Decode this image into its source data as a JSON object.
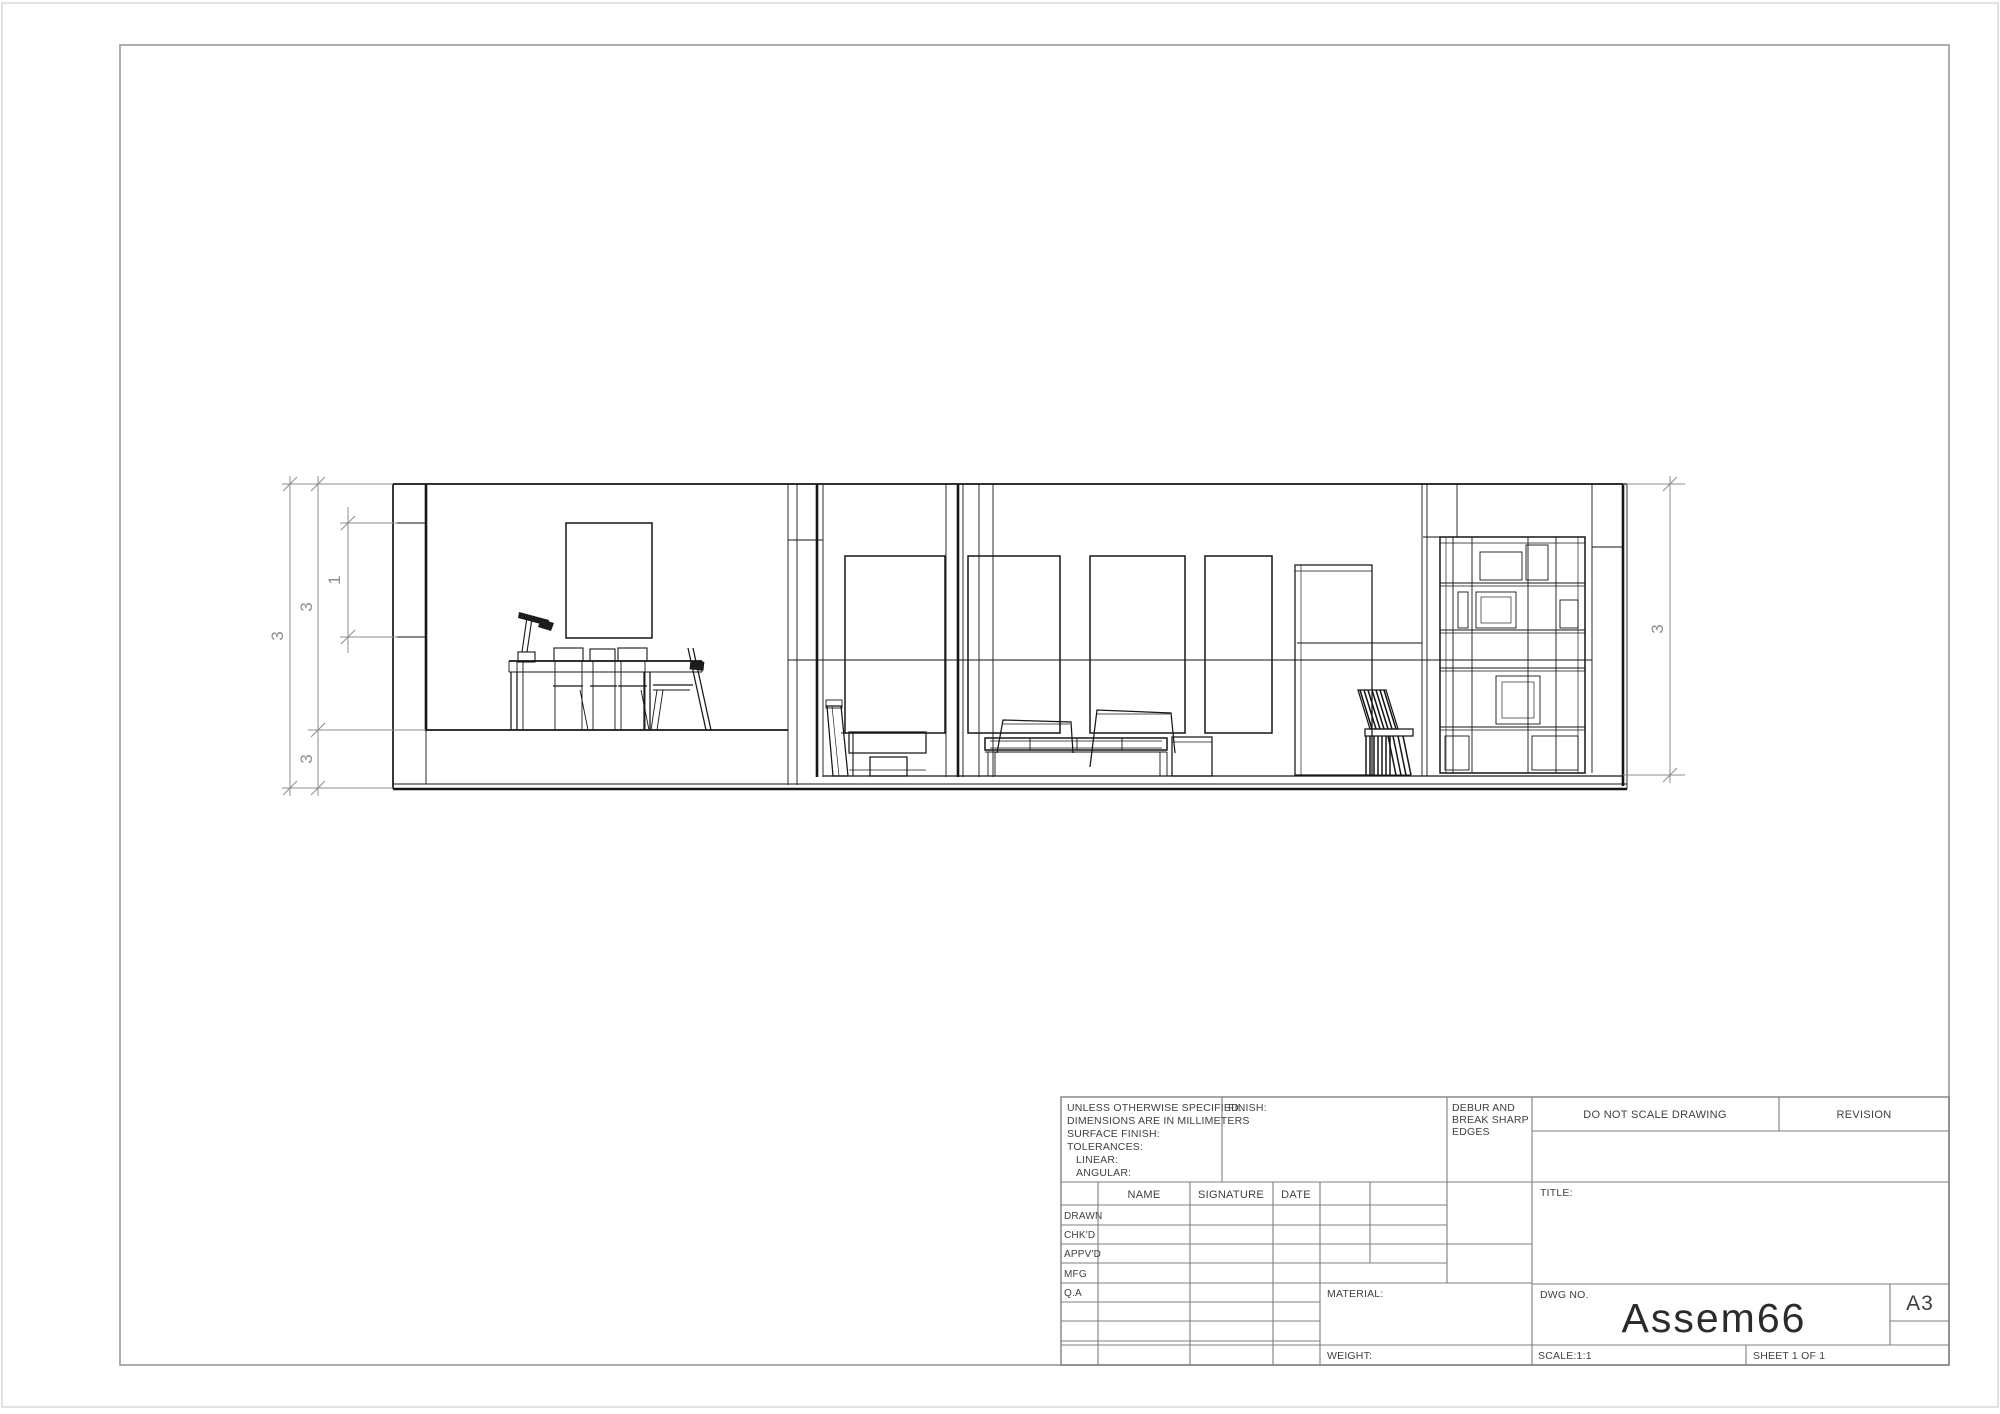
{
  "sheet": {
    "paper_size": "A3"
  },
  "title_block": {
    "spec_notes": [
      "UNLESS OTHERWISE SPECIFIED:",
      "DIMENSIONS ARE IN MILLIMETERS",
      "SURFACE FINISH:",
      "TOLERANCES:",
      "LINEAR:",
      "ANGULAR:"
    ],
    "finish_label": "FINISH:",
    "debur_lines": [
      "DEBUR AND",
      "BREAK SHARP",
      "EDGES"
    ],
    "do_not_scale": "DO NOT SCALE DRAWING",
    "revision_label": "REVISION",
    "table": {
      "headers": {
        "name": "NAME",
        "signature": "SIGNATURE",
        "date": "DATE"
      },
      "rows": [
        "DRAWN",
        "CHK'D",
        "APPV'D",
        "MFG",
        "Q.A"
      ]
    },
    "title_label": "TITLE:",
    "material_label": "MATERIAL:",
    "weight_label": "WEIGHT:",
    "dwg_no_label": "DWG NO.",
    "dwg_number": "Assem66",
    "size_label": "A3",
    "scale_text": "SCALE:1:1",
    "sheet_text": "SHEET 1 OF 1"
  },
  "drawing_view": {
    "description": "Front section elevation of interior assembly (dining area, living area with sofa, bookshelf)",
    "dimensions": {
      "left_overall_height": "3",
      "left_wall_height": "3",
      "left_floor_slab": "3",
      "left_window_opening": "1",
      "right_overall_height": "3"
    }
  },
  "colors": {
    "model_line": "#161616",
    "dimension_line": "#8e8e8e",
    "titleblock_line": "#7f7f7f",
    "border": "#9a9a9a",
    "background": "#ffffff"
  }
}
